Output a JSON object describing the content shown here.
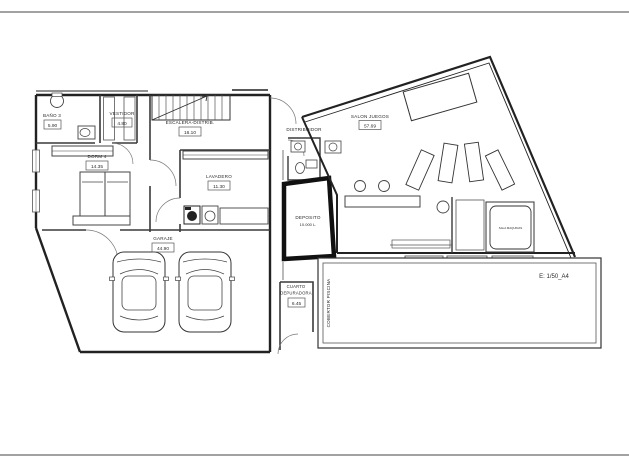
{
  "sheet": {
    "scale_label": "E: 1/50_A4"
  },
  "rooms": {
    "bano3": {
      "label": "BAÑO 3",
      "area": "5.90"
    },
    "vestidor": {
      "label": "VESTIDOR",
      "area": "4.80"
    },
    "escalera": {
      "label": "ESCALERA-DISTRIB.",
      "area": "16.10"
    },
    "dorm4": {
      "label": "DORM 4",
      "area": "14.35"
    },
    "lavadero": {
      "label": "LAVADERO",
      "area": "11.30"
    },
    "distribuidor": {
      "label": "DISTRIBUIDOR"
    },
    "salon": {
      "label": "SALON JUEGOS",
      "area": "57.69"
    },
    "deposito": {
      "label": "DEPOSITO",
      "capacity": "10.000 L."
    },
    "garaje": {
      "label": "GARAJE",
      "area": "44.90"
    },
    "cuarto_depuradora": {
      "label_line1": "CUARTO",
      "label_line2": "DEPURADORA",
      "area": "6.45"
    },
    "cobertor": {
      "label": "COBERTOR PISCINA"
    },
    "sala_maquinas": {
      "label": "SALA MAQUINAS"
    }
  },
  "colors": {
    "wall": "#222222",
    "line": "#555555",
    "background": "#ffffff",
    "deposito_outline": "#111111"
  }
}
